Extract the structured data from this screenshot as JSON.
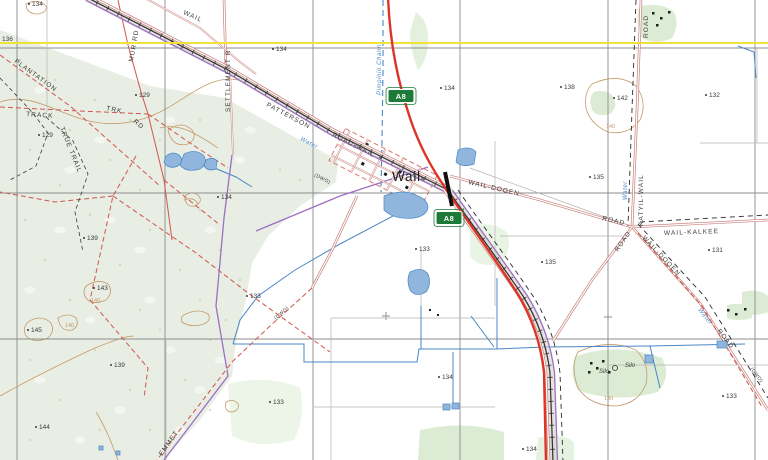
{
  "labels": {
    "town": "Wail",
    "shield": "A8",
    "roads": [
      "WAIL",
      "PATTERSON",
      "ROAD",
      "WAIL",
      "SETTLEMENT  R",
      "MUR  RD",
      "WAIL-DOOEN",
      "ROAD",
      "ROAD",
      "KATYIL-WAIL",
      "WAIL-KALKEE",
      "ROAD",
      "WAIL-DOOEN",
      "ROAD",
      "(DWO)",
      "PLANTATION",
      "TRACK",
      "TRK",
      "RD",
      "TRUE TRAIL",
      "EMMET",
      "(DWO)",
      "(DWO)"
    ],
    "water": [
      "Water",
      "Water",
      "Water",
      "Pimpinio Chann"
    ],
    "silos": [
      "Silo",
      "Silo"
    ],
    "spots": [
      "134",
      "136",
      "134",
      "134",
      "138",
      "142",
      "132",
      "129",
      "129",
      "134",
      "139",
      "143",
      "145",
      "139",
      "144",
      "133",
      "133",
      "133",
      "135",
      "135",
      "131",
      "134",
      "133",
      "134"
    ],
    "contours": [
      "140",
      "140",
      "140",
      "140"
    ]
  },
  "colors": {
    "forest": "#e8eee3",
    "patch": "#dcecd4",
    "grid": "#8c8c8c",
    "yellow": "#f0e23a",
    "highway": "#de3428",
    "roadc": "#c87f7a",
    "rail": "#2f2f2f",
    "pipe": "#9c6fc2",
    "water": "#4a86c5",
    "waterfill": "#90b6dd",
    "contour": "#c49a6a",
    "track": "#d2544c",
    "bound": "#2a2a2a",
    "label": "#3b3b3b",
    "shield": "#1e7a38"
  }
}
